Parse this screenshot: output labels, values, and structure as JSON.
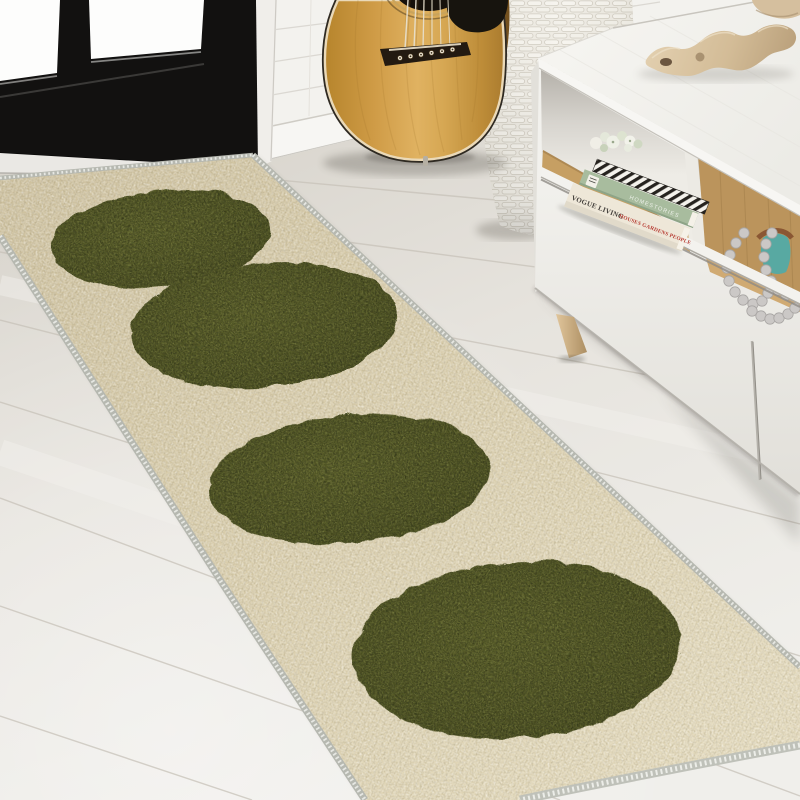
{
  "meta": {
    "description": "Lifestyle product photo: entryway with a black-framed glass door, natural acoustic guitar, white wicker basket and white media console on light wood plank flooring; a cream chenille runner rug with four large olive-green polka dots runs diagonally toward the viewer.",
    "photo_type": "rug product lifestyle photo"
  },
  "objects": {
    "door": {
      "label": "black glass-pane door",
      "color": "#121110",
      "glass_color": "#fdfdfc"
    },
    "wall": {
      "label": "white shiplap wall",
      "color": "#f3f2ee"
    },
    "floor": {
      "label": "light oak plank floor",
      "color": "#e7e4de",
      "seam_color": "#c7c2b8"
    },
    "rug": {
      "label": "cream runner rug with olive dots",
      "base_color": "#d8cca9",
      "dot_color": "#4f5226",
      "edge_color": "#b6b8b0",
      "dots_visible": 4
    },
    "guitar": {
      "label": "natural acoustic guitar",
      "body_color": "#d3a051",
      "pickguard_color": "#17140e",
      "string_count": 6
    },
    "basket": {
      "label": "tall white wicker basket",
      "color": "#ece9e1"
    },
    "console": {
      "label": "white media console with oak shelf interior",
      "color": "#f2f1ec",
      "shelf_interior_color": "#c49d66",
      "leg_color": "#c8ab7e"
    },
    "driftwood": {
      "label": "driftwood branch decor",
      "color": "#d2bc9b"
    },
    "beads": {
      "label": "gray decorative bead garland",
      "color": "#cbc8c6",
      "accent_teal": "#58a9a2",
      "strap_color": "#8a5733"
    },
    "flowers": {
      "label": "white-green faux succulent posy",
      "color": "#e9ecdf"
    }
  },
  "books": {
    "white_spine_title": "VOGUE LIVING",
    "white_spine_subtitle": "HOUSES GARDENS PEOPLE",
    "green_spine_title": "HOMESTORIES"
  }
}
